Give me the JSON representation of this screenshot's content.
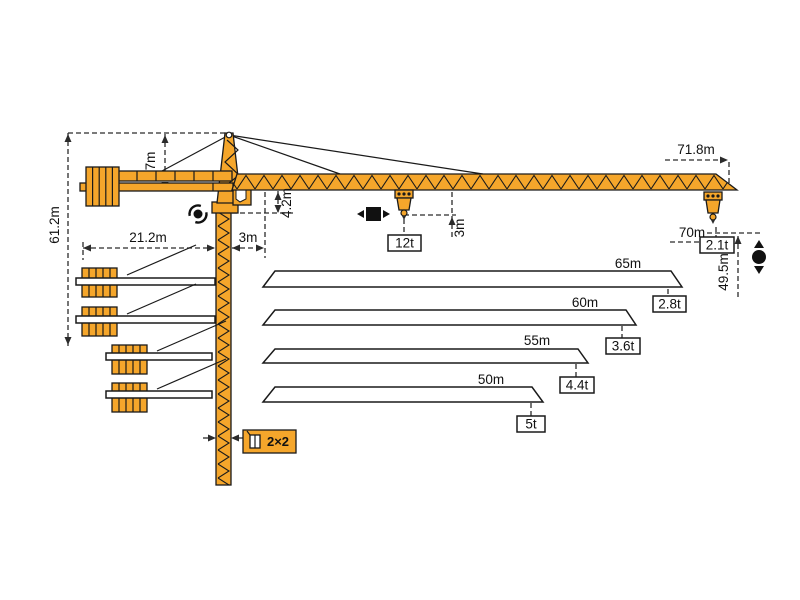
{
  "colors": {
    "crane_orange": "#F5A62B",
    "outline": "#1A1A1A",
    "dimension_lines": "#2B2B2B",
    "background": "#FFFFFF"
  },
  "dimensions": {
    "total_height": "61.2m",
    "head_height": "7m",
    "counter_jib_radius": "21.2m",
    "jib_root_offset": "3m",
    "jib_depth": "4.2m",
    "hook_to_jib": "3m",
    "max_trolley_capacity": "12t",
    "max_radius": "71.8m",
    "max_hook_radius": "70m",
    "tip_capacity": "2.1t",
    "hook_height": "49.5m",
    "mast_section": "2×2"
  },
  "jib_variants": [
    {
      "length": "65m",
      "tip_capacity": "2.8t"
    },
    {
      "length": "60m",
      "tip_capacity": "3.6t"
    },
    {
      "length": "55m",
      "tip_capacity": "4.4t"
    },
    {
      "length": "50m",
      "tip_capacity": "5t"
    }
  ],
  "icons": {
    "slew": "slewing-rotation",
    "trolley": "trolley-travel",
    "hoist": "hoist-up-down"
  }
}
